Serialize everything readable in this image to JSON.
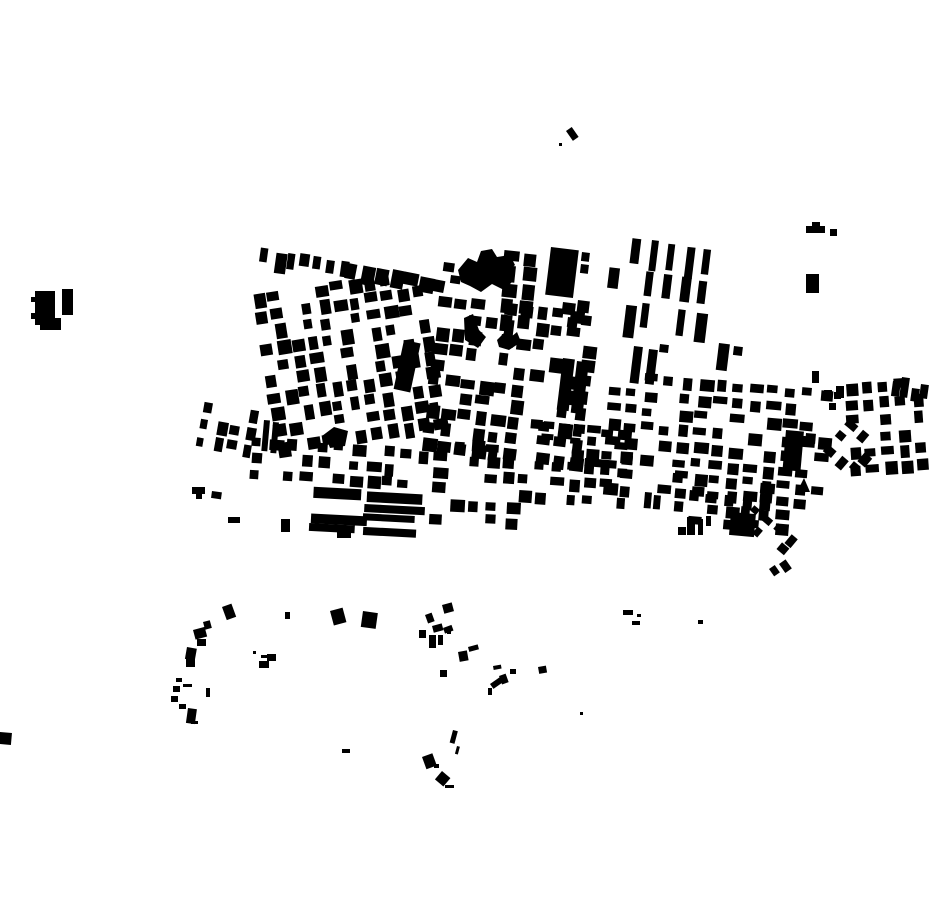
{
  "canvas": {
    "width": 930,
    "height": 924,
    "background": "#ffffff",
    "building_color": "#000000"
  },
  "map": {
    "kind": "building-footprint-map",
    "clusters": [
      {
        "id": "arc-west",
        "x": 262,
        "y": 249,
        "rot": 8,
        "rows": 1,
        "cols": 7,
        "cw": 10,
        "ch": 17,
        "gx": 3.5,
        "gy": 0,
        "density": 1.0,
        "seed": 11
      },
      {
        "id": "arc-east",
        "x": 347,
        "y": 262,
        "rot": 11,
        "rows": 1,
        "cols": 7,
        "cw": 12,
        "ch": 15,
        "gx": 3,
        "gy": 0,
        "density": 1.0,
        "seed": 22
      },
      {
        "id": "grid-upper-left",
        "x": 252,
        "y": 296,
        "rot": -9,
        "rows": 10,
        "cols": 11,
        "cw": 11.5,
        "ch": 12,
        "gx": 4.5,
        "gy": 4.5,
        "density": 0.74,
        "seed": 33
      },
      {
        "id": "grid-center",
        "x": 440,
        "y": 295,
        "rot": 7,
        "rows": 10,
        "cols": 10,
        "cw": 12,
        "ch": 12,
        "gx": 4.5,
        "gy": 4,
        "density": 0.72,
        "seed": 44
      },
      {
        "id": "topcenter-col",
        "x": 506,
        "y": 250,
        "rot": 6,
        "rows": 5,
        "cols": 2,
        "cw": 13,
        "ch": 13,
        "gx": 6,
        "gy": 3,
        "density": 0.9,
        "seed": 199
      },
      {
        "id": "rowhouses",
        "x": 615,
        "y": 237,
        "rot": 7,
        "rows": 3,
        "cols": 6,
        "cw": 9.5,
        "ch": 27,
        "gx": 8.5,
        "gy": 5,
        "density": 0.88,
        "seed": 66
      },
      {
        "id": "grid-right-mid",
        "x": 612,
        "y": 372,
        "rot": 5,
        "rows": 8,
        "cols": 13,
        "cw": 12,
        "ch": 10,
        "gx": 5.5,
        "gy": 6,
        "density": 0.68,
        "seed": 77
      },
      {
        "id": "grid-far-right",
        "x": 845,
        "y": 383,
        "rot": -4,
        "rows": 6,
        "cols": 5,
        "cw": 11,
        "ch": 11,
        "gx": 5.5,
        "gy": 5.5,
        "density": 0.72,
        "seed": 88
      },
      {
        "id": "diamonds-far-right",
        "x": 850,
        "y": 420,
        "rot": 40,
        "rows": 3,
        "cols": 3,
        "cw": 10,
        "ch": 10,
        "gx": 5.5,
        "gy": 5.5,
        "density": 0.8,
        "seed": 99
      },
      {
        "id": "band-left-rows",
        "x": 253,
        "y": 438,
        "rot": 4,
        "rows": 3,
        "cols": 12,
        "cw": 12,
        "ch": 10,
        "gx": 4.5,
        "gy": 5,
        "density": 0.78,
        "seed": 111
      },
      {
        "id": "band-center-rows",
        "x": 455,
        "y": 440,
        "rot": 4,
        "rows": 4,
        "cols": 11,
        "cw": 11,
        "ch": 10,
        "gx": 5.5,
        "gy": 5,
        "density": 0.7,
        "seed": 122
      },
      {
        "id": "longrows-south",
        "x": 312,
        "y": 487,
        "rot": 3,
        "rows": 4,
        "cols": 2,
        "cw": 48,
        "ch": 9,
        "gx": 6,
        "gy": 3.5,
        "density": 0.95,
        "seed": 133
      },
      {
        "id": "south-center-bits",
        "x": 430,
        "y": 498,
        "rot": 3,
        "rows": 2,
        "cols": 5,
        "cw": 13,
        "ch": 10,
        "gx": 6,
        "gy": 5,
        "density": 0.7,
        "seed": 144
      },
      {
        "id": "grid-bottom-right",
        "x": 660,
        "y": 470,
        "rot": 5,
        "rows": 4,
        "cols": 8,
        "cw": 12,
        "ch": 10,
        "gx": 5,
        "gy": 5,
        "density": 0.72,
        "seed": 155
      },
      {
        "id": "diamonds-bottom-right",
        "x": 757,
        "y": 505,
        "rot": 40,
        "rows": 2,
        "cols": 4,
        "cw": 9,
        "ch": 9,
        "gx": 5.5,
        "gy": 5.5,
        "density": 0.85,
        "seed": 166
      },
      {
        "id": "scatter-west-edge",
        "x": 205,
        "y": 402,
        "rot": 10,
        "rows": 3,
        "cols": 4,
        "cw": 9,
        "ch": 11,
        "gx": 6,
        "gy": 6,
        "density": 0.7,
        "seed": 177
      },
      {
        "id": "strip-center-south",
        "x": 530,
        "y": 421,
        "rot": 5,
        "rows": 2,
        "cols": 7,
        "cw": 11,
        "ch": 8,
        "gx": 3.5,
        "gy": 4,
        "density": 0.8,
        "seed": 188
      }
    ],
    "buildings": [
      {
        "x": 444,
        "y": 262,
        "w": 11,
        "h": 9,
        "r": 8
      },
      {
        "x": 451,
        "y": 275,
        "w": 10,
        "h": 8,
        "r": 8
      },
      {
        "x": 404,
        "y": 340,
        "w": 17,
        "h": 50,
        "r": 12
      },
      {
        "x": 563,
        "y": 358,
        "w": 12,
        "h": 52,
        "r": 7
      },
      {
        "x": 577,
        "y": 361,
        "w": 12,
        "h": 52,
        "r": 7
      },
      {
        "x": 551,
        "y": 247,
        "w": 28,
        "h": 48,
        "r": 7
      },
      {
        "x": 582,
        "y": 252,
        "w": 8,
        "h": 9,
        "r": 7
      },
      {
        "x": 581,
        "y": 264,
        "w": 8,
        "h": 9,
        "r": 7
      },
      {
        "x": 563,
        "y": 302,
        "w": 13,
        "h": 12,
        "r": 7
      },
      {
        "x": 578,
        "y": 300,
        "w": 12,
        "h": 12,
        "r": 7
      },
      {
        "x": 568,
        "y": 317,
        "w": 10,
        "h": 10,
        "r": 7
      },
      {
        "x": 582,
        "y": 315,
        "w": 10,
        "h": 10,
        "r": 7
      },
      {
        "x": 719,
        "y": 343,
        "w": 11,
        "h": 27,
        "r": 7
      },
      {
        "x": 734,
        "y": 346,
        "w": 9,
        "h": 9,
        "r": 7
      },
      {
        "x": 634,
        "y": 346,
        "w": 9,
        "h": 37,
        "r": 7
      },
      {
        "x": 649,
        "y": 349,
        "w": 9,
        "h": 35,
        "r": 7
      },
      {
        "x": 660,
        "y": 344,
        "w": 9,
        "h": 8,
        "r": 7
      },
      {
        "x": 786,
        "y": 430,
        "w": 18,
        "h": 40,
        "r": 5
      },
      {
        "x": 806,
        "y": 433,
        "w": 10,
        "h": 10,
        "r": 5
      },
      {
        "x": 893,
        "y": 381,
        "w": 8,
        "h": 15,
        "r": 8
      },
      {
        "x": 902,
        "y": 377,
        "w": 8,
        "h": 20,
        "r": 8
      },
      {
        "x": 912,
        "y": 388,
        "w": 8,
        "h": 13,
        "r": 8
      },
      {
        "x": 921,
        "y": 384,
        "w": 8,
        "h": 14,
        "r": 8
      },
      {
        "x": 836,
        "y": 386,
        "w": 8,
        "h": 12,
        "r": 0
      },
      {
        "x": 812,
        "y": 371,
        "w": 7,
        "h": 12,
        "r": 0
      },
      {
        "x": 824,
        "y": 390,
        "w": 8,
        "h": 8,
        "r": 0
      },
      {
        "x": 834,
        "y": 392,
        "w": 7,
        "h": 7,
        "r": 0
      },
      {
        "x": 829,
        "y": 403,
        "w": 7,
        "h": 7,
        "r": 0
      },
      {
        "x": 731,
        "y": 512,
        "w": 25,
        "h": 23,
        "r": 5
      },
      {
        "x": 754,
        "y": 520,
        "w": 5,
        "h": 8,
        "r": 5
      },
      {
        "x": 678,
        "y": 527,
        "w": 8,
        "h": 8,
        "r": 0
      },
      {
        "x": 687,
        "y": 517,
        "w": 8,
        "h": 18,
        "r": 0
      },
      {
        "x": 698,
        "y": 519,
        "w": 5,
        "h": 16,
        "r": 0
      },
      {
        "x": 706,
        "y": 516,
        "w": 5,
        "h": 10,
        "r": 0
      },
      {
        "x": 645,
        "y": 492,
        "w": 7,
        "h": 16,
        "r": 5
      },
      {
        "x": 654,
        "y": 495,
        "w": 7,
        "h": 14,
        "r": 5
      },
      {
        "x": 585,
        "y": 458,
        "w": 32,
        "h": 8,
        "r": 5
      },
      {
        "x": 769,
        "y": 569,
        "w": 7,
        "h": 9,
        "r": -35
      },
      {
        "x": 779,
        "y": 564,
        "w": 8,
        "h": 11,
        "r": -35
      },
      {
        "x": 264,
        "y": 420,
        "w": 6,
        "h": 31,
        "r": 5
      },
      {
        "x": 273,
        "y": 422,
        "w": 6,
        "h": 31,
        "r": 5
      },
      {
        "x": 192,
        "y": 487,
        "w": 13,
        "h": 7,
        "r": 0
      },
      {
        "x": 196,
        "y": 494,
        "w": 6,
        "h": 5,
        "r": 0
      },
      {
        "x": 212,
        "y": 491,
        "w": 10,
        "h": 7,
        "r": 8
      },
      {
        "x": 228,
        "y": 517,
        "w": 12,
        "h": 6,
        "r": 0
      },
      {
        "x": 281,
        "y": 519,
        "w": 9,
        "h": 13,
        "r": 0
      },
      {
        "x": 337,
        "y": 532,
        "w": 14,
        "h": 6,
        "r": 0
      },
      {
        "x": 62,
        "y": 289,
        "w": 11,
        "h": 26,
        "r": 0
      },
      {
        "x": 31,
        "y": 297,
        "w": 4,
        "h": 5,
        "r": 0
      },
      {
        "x": 31,
        "y": 313,
        "w": 4,
        "h": 6,
        "r": 0
      },
      {
        "x": 566,
        "y": 131,
        "w": 7,
        "h": 12,
        "r": -35
      },
      {
        "x": 559,
        "y": 143,
        "w": 3,
        "h": 3,
        "r": 0
      },
      {
        "x": 806,
        "y": 226,
        "w": 19,
        "h": 7,
        "r": 0
      },
      {
        "x": 812,
        "y": 222,
        "w": 8,
        "h": 4,
        "r": 0
      },
      {
        "x": 830,
        "y": 229,
        "w": 7,
        "h": 7,
        "r": 0
      },
      {
        "x": 806,
        "y": 274,
        "w": 13,
        "h": 19,
        "r": 0
      },
      {
        "x": 0,
        "y": 732,
        "w": 12,
        "h": 12,
        "r": 5
      },
      {
        "x": 698,
        "y": 620,
        "w": 5,
        "h": 4,
        "r": 0
      },
      {
        "x": 580,
        "y": 712,
        "w": 3,
        "h": 3,
        "r": 0
      },
      {
        "x": 222,
        "y": 607,
        "w": 10,
        "h": 14,
        "r": -20
      },
      {
        "x": 203,
        "y": 622,
        "w": 7,
        "h": 8,
        "r": -15
      },
      {
        "x": 193,
        "y": 630,
        "w": 12,
        "h": 10,
        "r": -15
      },
      {
        "x": 197,
        "y": 639,
        "w": 9,
        "h": 7,
        "r": 0
      },
      {
        "x": 187,
        "y": 647,
        "w": 10,
        "h": 12,
        "r": 10
      },
      {
        "x": 186,
        "y": 658,
        "w": 9,
        "h": 9,
        "r": 0
      },
      {
        "x": 176,
        "y": 678,
        "w": 6,
        "h": 4,
        "r": 0
      },
      {
        "x": 173,
        "y": 686,
        "w": 7,
        "h": 6,
        "r": 0
      },
      {
        "x": 183,
        "y": 684,
        "w": 9,
        "h": 3,
        "r": 0
      },
      {
        "x": 171,
        "y": 696,
        "w": 7,
        "h": 6,
        "r": 0
      },
      {
        "x": 179,
        "y": 704,
        "w": 7,
        "h": 5,
        "r": 0
      },
      {
        "x": 188,
        "y": 708,
        "w": 9,
        "h": 15,
        "r": 8
      },
      {
        "x": 191,
        "y": 721,
        "w": 7,
        "h": 3,
        "r": 0
      },
      {
        "x": 206,
        "y": 688,
        "w": 4,
        "h": 9,
        "r": 0
      },
      {
        "x": 253,
        "y": 651,
        "w": 3,
        "h": 3,
        "r": 0
      },
      {
        "x": 261,
        "y": 655,
        "w": 6,
        "h": 3,
        "r": 0
      },
      {
        "x": 267,
        "y": 654,
        "w": 9,
        "h": 7,
        "r": 0
      },
      {
        "x": 259,
        "y": 661,
        "w": 10,
        "h": 7,
        "r": 0
      },
      {
        "x": 285,
        "y": 612,
        "w": 5,
        "h": 7,
        "r": 0
      },
      {
        "x": 330,
        "y": 611,
        "w": 13,
        "h": 15,
        "r": -15
      },
      {
        "x": 363,
        "y": 611,
        "w": 15,
        "h": 16,
        "r": 8
      },
      {
        "x": 442,
        "y": 605,
        "w": 10,
        "h": 9,
        "r": -15
      },
      {
        "x": 425,
        "y": 615,
        "w": 7,
        "h": 9,
        "r": -20
      },
      {
        "x": 432,
        "y": 626,
        "w": 10,
        "h": 7,
        "r": -15
      },
      {
        "x": 419,
        "y": 630,
        "w": 7,
        "h": 8,
        "r": 0
      },
      {
        "x": 443,
        "y": 628,
        "w": 9,
        "h": 6,
        "r": -20
      },
      {
        "x": 429,
        "y": 635,
        "w": 7,
        "h": 13,
        "r": 0
      },
      {
        "x": 438,
        "y": 635,
        "w": 5,
        "h": 10,
        "r": 0
      },
      {
        "x": 447,
        "y": 631,
        "w": 4,
        "h": 3,
        "r": 0
      },
      {
        "x": 458,
        "y": 652,
        "w": 9,
        "h": 10,
        "r": -10
      },
      {
        "x": 468,
        "y": 647,
        "w": 10,
        "h": 5,
        "r": -15
      },
      {
        "x": 440,
        "y": 670,
        "w": 7,
        "h": 7,
        "r": 0
      },
      {
        "x": 493,
        "y": 666,
        "w": 8,
        "h": 4,
        "r": -10
      },
      {
        "x": 510,
        "y": 669,
        "w": 6,
        "h": 5,
        "r": 0
      },
      {
        "x": 538,
        "y": 667,
        "w": 8,
        "h": 7,
        "r": -10
      },
      {
        "x": 490,
        "y": 684,
        "w": 12,
        "h": 6,
        "r": -35
      },
      {
        "x": 499,
        "y": 676,
        "w": 7,
        "h": 9,
        "r": -20
      },
      {
        "x": 488,
        "y": 688,
        "w": 4,
        "h": 7,
        "r": 0
      },
      {
        "x": 453,
        "y": 730,
        "w": 5,
        "h": 13,
        "r": 15
      },
      {
        "x": 457,
        "y": 746,
        "w": 3,
        "h": 8,
        "r": 15
      },
      {
        "x": 623,
        "y": 610,
        "w": 10,
        "h": 5,
        "r": 0
      },
      {
        "x": 637,
        "y": 614,
        "w": 4,
        "h": 3,
        "r": 0
      },
      {
        "x": 632,
        "y": 621,
        "w": 8,
        "h": 4,
        "r": 0
      },
      {
        "x": 342,
        "y": 749,
        "w": 8,
        "h": 4,
        "r": 0
      },
      {
        "x": 422,
        "y": 757,
        "w": 11,
        "h": 13,
        "r": -20
      },
      {
        "x": 434,
        "y": 764,
        "w": 5,
        "h": 4,
        "r": 0
      },
      {
        "x": 442,
        "y": 771,
        "w": 11,
        "h": 11,
        "r": 40
      },
      {
        "x": 445,
        "y": 785,
        "w": 9,
        "h": 3,
        "r": 0
      }
    ],
    "polygons": [
      {
        "id": "west-isolated-block",
        "points": "35,291 55,291 55,318 61,318 61,330 40,330 40,325 35,325"
      },
      {
        "id": "irregular-plus-block",
        "points": "458,270 468,258 477,262 481,251 492,249 497,257 510,255 515,265 507,272 514,280 504,290 492,284 481,292 470,286 461,282"
      },
      {
        "id": "boot-block",
        "points": "464,318 473,314 479,330 486,337 478,348 465,340"
      },
      {
        "id": "bird-block",
        "points": "497,340 505,332 511,337 517,332 521,342 509,350 499,347"
      },
      {
        "id": "arrow-block-west",
        "points": "322,436 334,427 348,431 345,446 330,448 327,440"
      },
      {
        "id": "triangle-block-right",
        "points": "797,492 810,492 804,478"
      }
    ]
  }
}
